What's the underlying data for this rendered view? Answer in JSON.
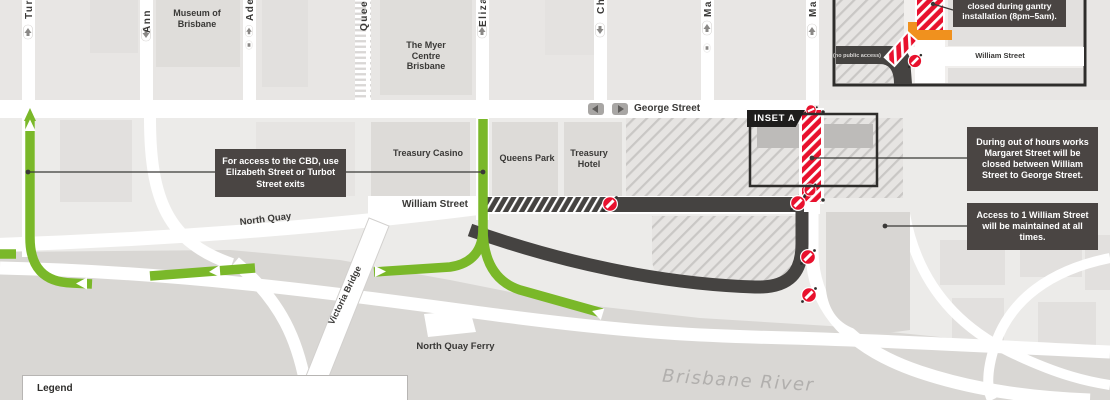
{
  "colors": {
    "route_green": "#7ab829",
    "closure_red": "#e8112d",
    "gantry_orange": "#f0911e",
    "callout_bg": "#4a4543",
    "dark_road": "#454341",
    "background": "#ecebe9"
  },
  "vertical_streets": [
    {
      "label": "Turbot"
    },
    {
      "label": "Ann"
    },
    {
      "label": "Adelaide"
    },
    {
      "label": "Queen"
    },
    {
      "label": "Elizabeth"
    },
    {
      "label": "Charlotte"
    },
    {
      "label": "Mary"
    },
    {
      "label": "Margaret"
    }
  ],
  "streets": {
    "george": "George Street",
    "william": "William Street",
    "north_quay": "North Quay",
    "victoria_bridge": "Victoria Bridge"
  },
  "places": {
    "museum": "Museum of Brisbane",
    "myer_centre": "The Myer Centre Brisbane",
    "treasury_casino": "Treasury Casino",
    "queens_park": "Queens Park",
    "treasury_hotel": "Treasury Hotel",
    "ferry": "North Quay Ferry",
    "river": "Brisbane River"
  },
  "callouts": {
    "cbd": "For access to the CBD, use Elizabeth Street or Turbot Street exits",
    "margaret": "During out of hours works Margaret Street will be closed between William Street to George Street.",
    "william_access": "Access to 1 William Street will be maintained at all times."
  },
  "inset": {
    "tag": "INSET A",
    "callout": "closed during gantry installation (8pm–5am).",
    "street": "William Street",
    "no_access": "(no public access)"
  },
  "legend": {
    "title": "Legend"
  }
}
